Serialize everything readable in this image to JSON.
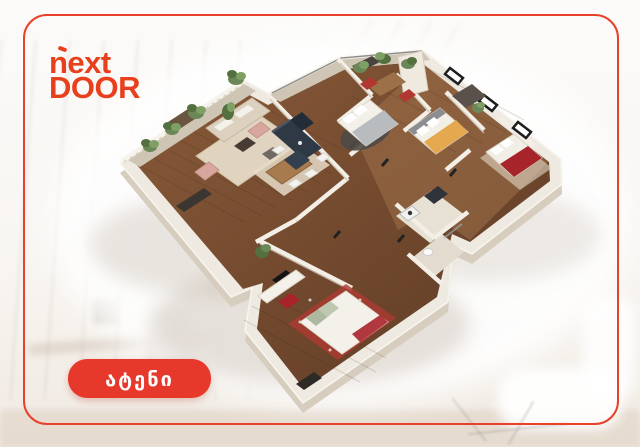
{
  "frame": {
    "border_color": "#E8402A"
  },
  "logo": {
    "line1": "next",
    "line2": "DOOR",
    "color": "#E8401D"
  },
  "badge": {
    "label": "ატენი",
    "bg_color": "#E6392B",
    "text_color": "#FFFFFF"
  },
  "floorplan": {
    "alt": "3D isometric cutaway floor plan of a furnished multi-room apartment",
    "style": "isometric-render",
    "palette": {
      "walls": "#EFEAE1",
      "floor_dark_wood": "#6E452C",
      "floor_light_wood": "#8F5E3C",
      "kitchen_cabinets": "#2E3945",
      "sofa": "#DCD1BF",
      "accent_chairs": "#D8A69D",
      "bed_blanket_yellow": "#E4A94E",
      "bed_blanket_red": "#A8242B",
      "plants": "#6B8657",
      "bathroom_tile": "#E7E1D4"
    },
    "rooms": [
      {
        "name": "living-room",
        "items": [
          "sofa",
          "coffee-table",
          "accent-armchairs",
          "rug",
          "tv-stand"
        ]
      },
      {
        "name": "dining-area",
        "items": [
          "dining-table",
          "white-chairs",
          "rug"
        ]
      },
      {
        "name": "kitchen",
        "items": [
          "navy-cabinet-run",
          "island",
          "fridge"
        ]
      },
      {
        "name": "study",
        "items": [
          "desk",
          "red-chairs",
          "shelving"
        ]
      },
      {
        "name": "bedroom-gray",
        "items": [
          "double-bed",
          "round-dark-rug"
        ]
      },
      {
        "name": "bedroom-yellow",
        "items": [
          "double-bed-yellow-blanket",
          "wardrobe"
        ]
      },
      {
        "name": "bedroom-red",
        "items": [
          "double-bed-red-blanket"
        ]
      },
      {
        "name": "master-bedroom",
        "items": [
          "bed-with-red-throw",
          "sideboard",
          "tv",
          "red-ottoman",
          "patterned-red-rug"
        ]
      },
      {
        "name": "bathrooms",
        "items": [
          "toilet",
          "vanity",
          "washer",
          "shower-glass"
        ]
      },
      {
        "name": "balconies",
        "items": [
          "potted-plants",
          "lattice-fence",
          "railing"
        ]
      }
    ]
  },
  "background": {
    "description": "blurred white home-office interior",
    "tint": "#F5F2EE"
  }
}
